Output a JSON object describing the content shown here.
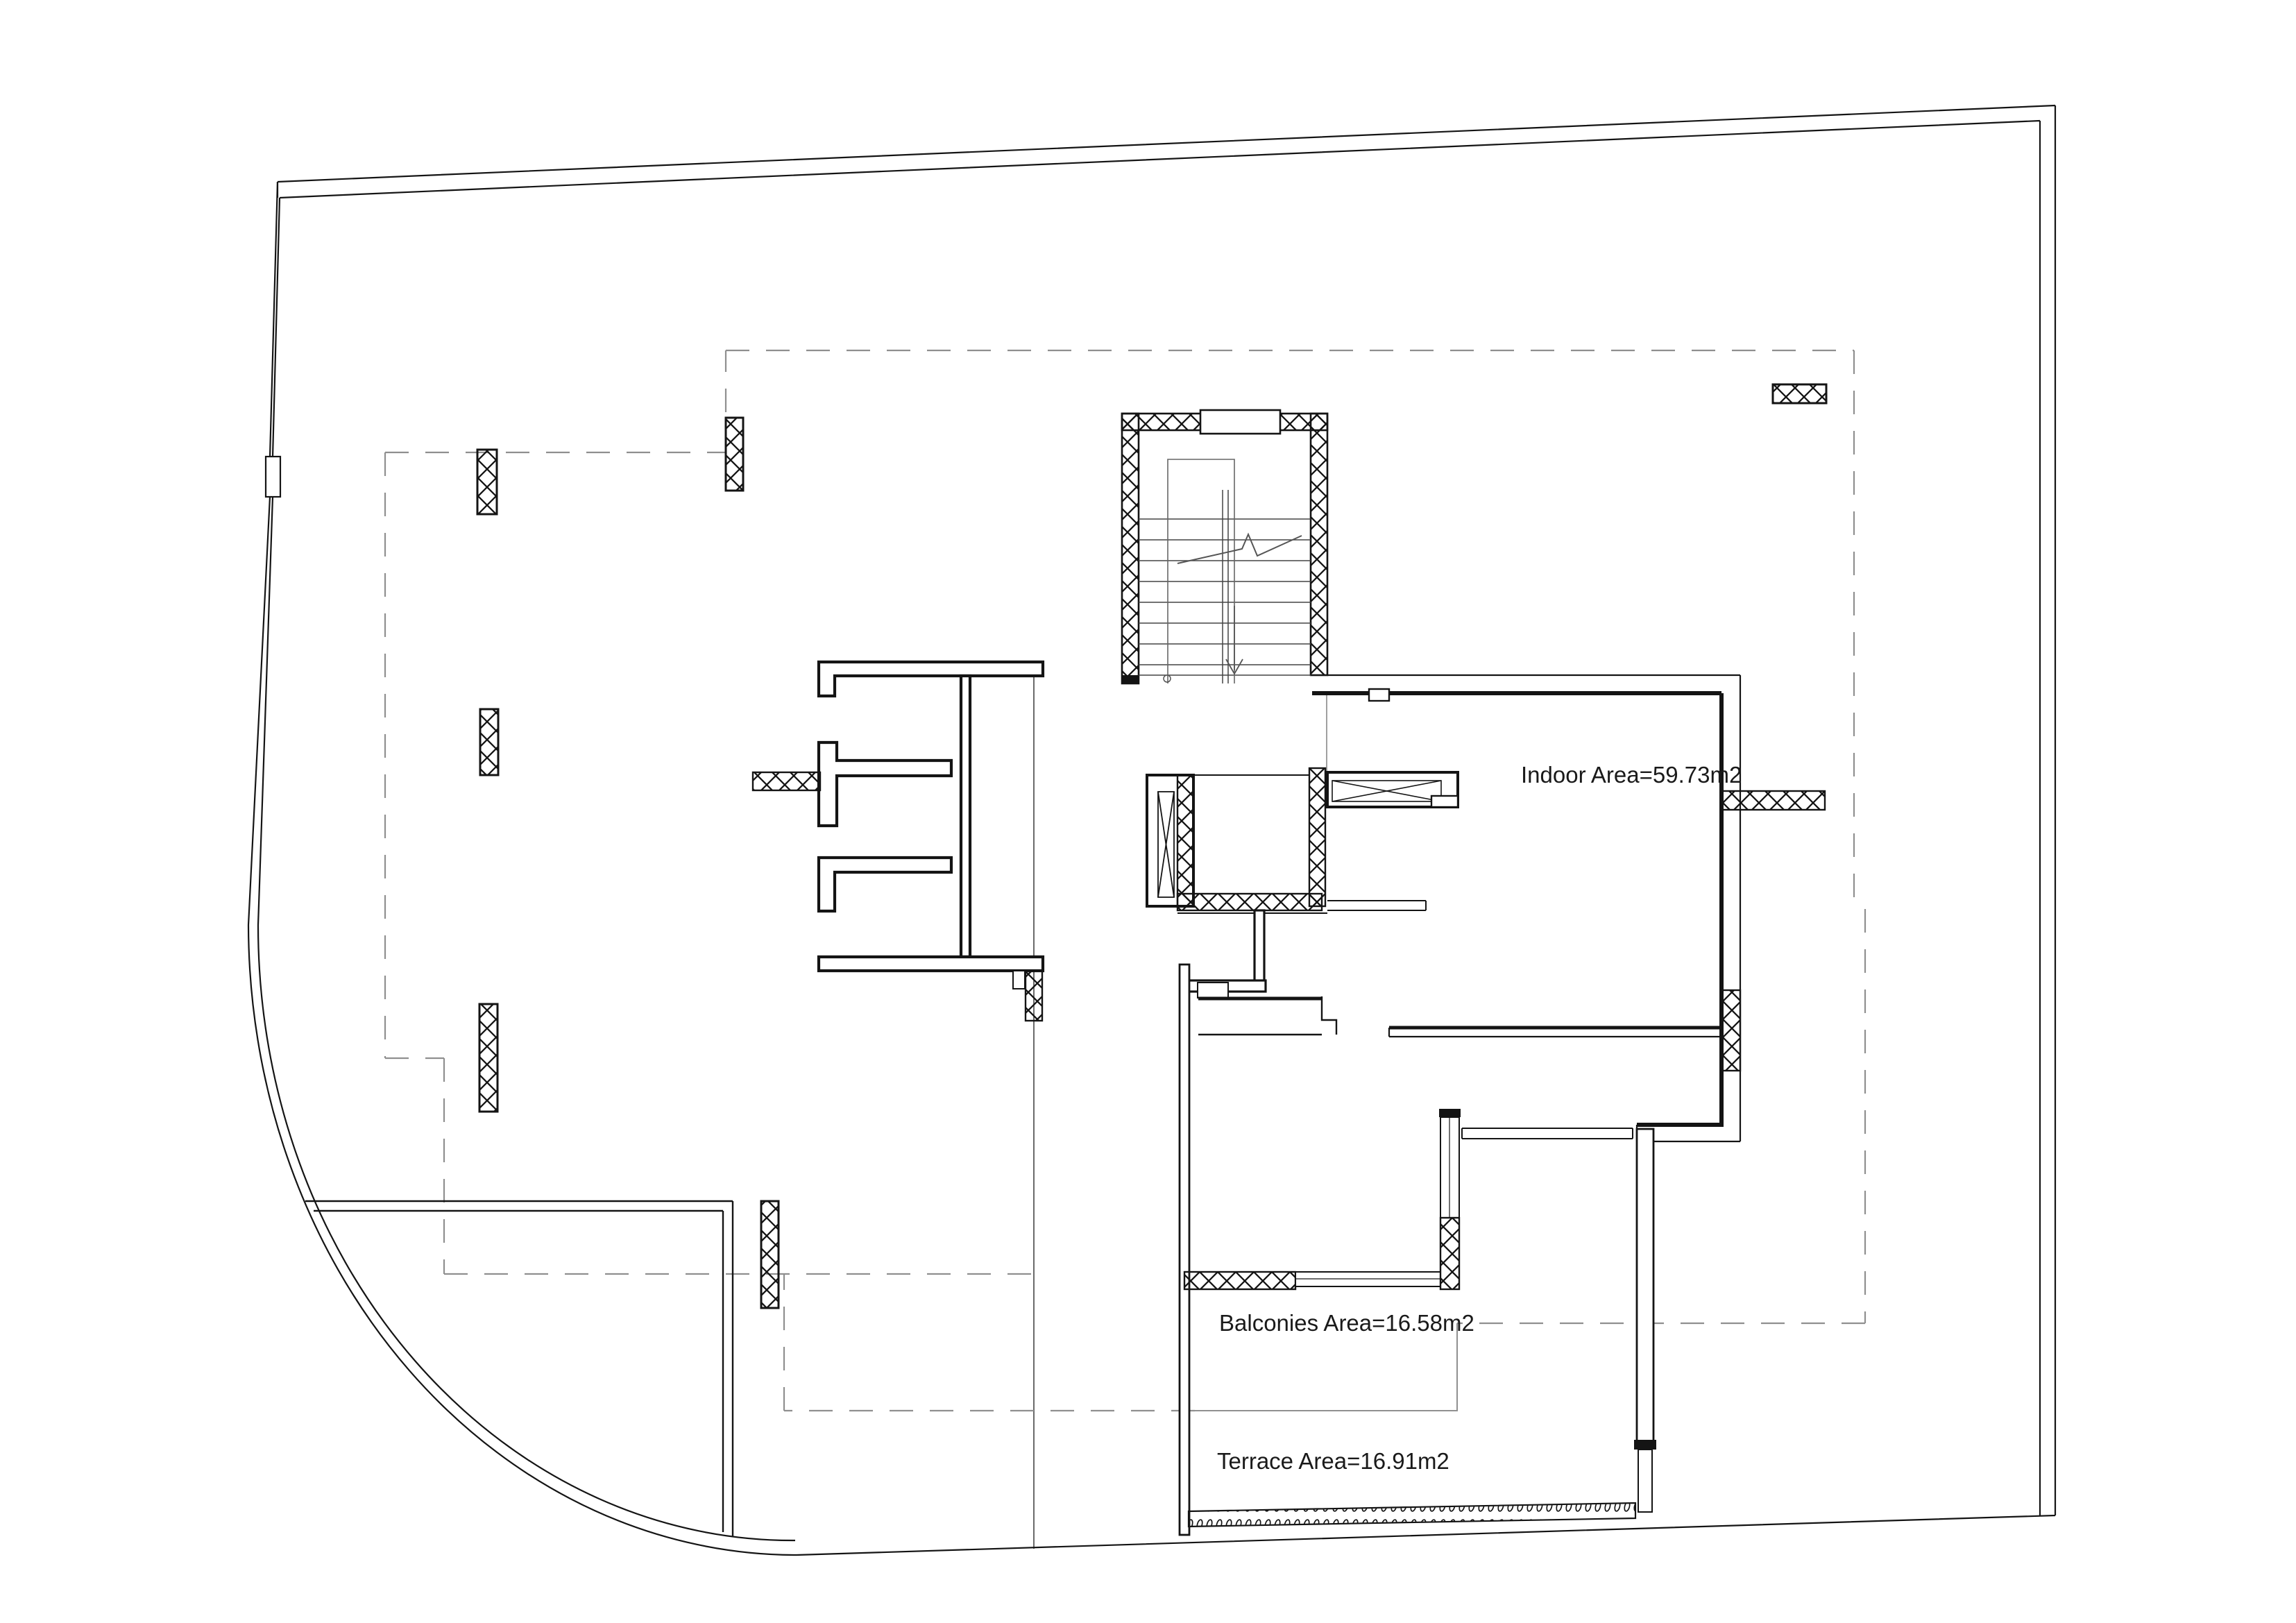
{
  "document": {
    "type": "architectural floor plan drawing",
    "background_color": "#ffffff",
    "line_color": "#141414",
    "faint_line_color": "#8f8f8f"
  },
  "labels": {
    "indoor_area": "Indoor Area=59.73m2",
    "balconies_area": "Balconies Area=16.58m2",
    "terrace_area": "Terrace Area=16.91m2"
  },
  "symbols": [
    "property-boundary-line",
    "setback-dashed-line",
    "crosshatched-wall",
    "structural-column",
    "staircase-with-down-arrow",
    "elevator-shaft",
    "window-double-line",
    "terrace-parapet-hatch"
  ]
}
